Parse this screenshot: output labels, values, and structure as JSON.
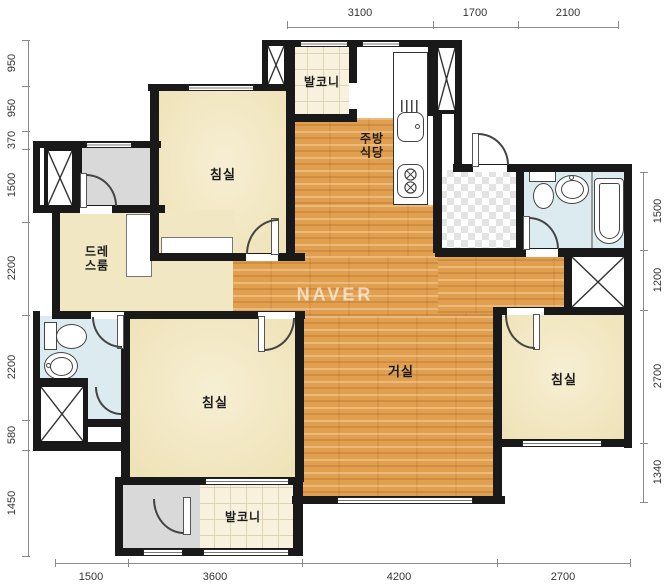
{
  "watermark": "NAVER",
  "labels": {
    "bedroom_top_left": "침실",
    "bedroom_bottom_left": "침실",
    "bedroom_right": "침실",
    "living_room": "거실",
    "kitchen_line1": "주방",
    "kitchen_line2": "식당",
    "dress_line1": "드레",
    "dress_line2": "스룸",
    "balcony_top": "발코니",
    "balcony_bottom": "발코니"
  },
  "dimensions": {
    "top": [
      "3100",
      "1700",
      "2100"
    ],
    "left": [
      "950",
      "950",
      "370",
      "1500",
      "2200",
      "2200",
      "580",
      "1450"
    ],
    "right": [
      "1500",
      "1200",
      "2700",
      "1340"
    ],
    "bottom": [
      "1500",
      "3600",
      "4200",
      "2700"
    ]
  },
  "colors": {
    "wall": "#191919",
    "wood_floor": "#e1a050",
    "room_cream": "#efe4ba",
    "balcony_tile": "#f8f1dd",
    "bathroom_blue": "#dcebf0",
    "utility_gray": "#d9d9d9",
    "dimension_text": "#333333",
    "watermark_white": "#ffffff"
  }
}
